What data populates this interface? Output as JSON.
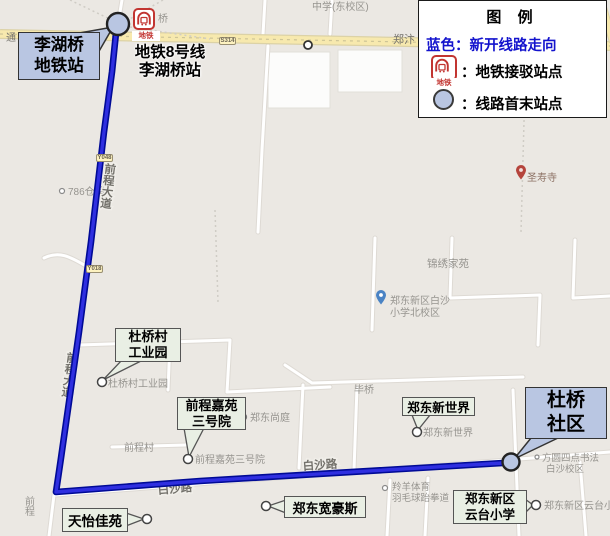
{
  "map": {
    "legend": {
      "title": "图  例",
      "route_item": "蓝色：新开线路走向",
      "metro_item": "：地铁接驳站点",
      "terminal_item": "：线路首末站点"
    },
    "metro_icon_text": "地铁",
    "route": {
      "start_callout_line1": "李湖桥",
      "start_callout_line2": "地铁站",
      "start_caption_line1": "地铁8号线",
      "start_caption_line2": "李湖桥站",
      "end_callout_line1": "杜桥",
      "end_callout_line2": "社区"
    },
    "callouts": {
      "duqiaocun_line1": "杜桥村",
      "duqiaocun_line2": "工业园",
      "qianchengjiayuan_line1": "前程嘉苑",
      "qianchengjiayuan_line2": "三号院",
      "zhengdong_new_world": "郑东新世界",
      "tianyi_jiayuan": "天怡佳苑",
      "zhengdong_kuanhaosi": "郑东宽豪斯",
      "yuntai_line1": "郑东新区",
      "yuntai_line2": "云台小学"
    },
    "shields": {
      "s314": "S314",
      "y048": "Y048",
      "y018": "Y018"
    },
    "labels": {
      "middle_school": "中学(东校区)",
      "qiao": "桥",
      "zhengbian": "郑汴",
      "tong": "通",
      "warehouse786": "786仓储",
      "qiancheng_avenue": "前程大道",
      "qiancheng_partial": "前程",
      "duqiaocun_poi": "杜桥村工业园",
      "qianchengcun": "前程村",
      "qianchengjiayuan_poi": "前程嘉苑三号院",
      "zhengdong_shangting": "郑东尚庭",
      "biqiao": "毕桥",
      "jinxiu_jiayuan": "锦绣家苑",
      "baisha_school_line1": "郑东新区白沙",
      "baisha_school_line2": "小学北校区",
      "shengshou_temple": "圣寿寺",
      "zhengdong_new_world_poi": "郑东新世界",
      "fangyuan_line1": "方圆四点书法",
      "fangyuan_line2": "白沙校区",
      "lingyang_line1": "羚羊体育",
      "lingyang_line2": "羽毛球跆拳道",
      "yuntai_poi": "郑东新区云台小学",
      "baisha_road": "白沙路"
    },
    "colors": {
      "route_blue": "#2f2fe0",
      "route_casing": "#000a96",
      "station_fill": "#b9c6e2",
      "callout_blue": "#b9c6e2",
      "callout_green": "#e9efe4",
      "legend_blue_text": "#1313cd",
      "metro_red": "#c23531",
      "highway_yellow": "#f7e9ae"
    }
  }
}
